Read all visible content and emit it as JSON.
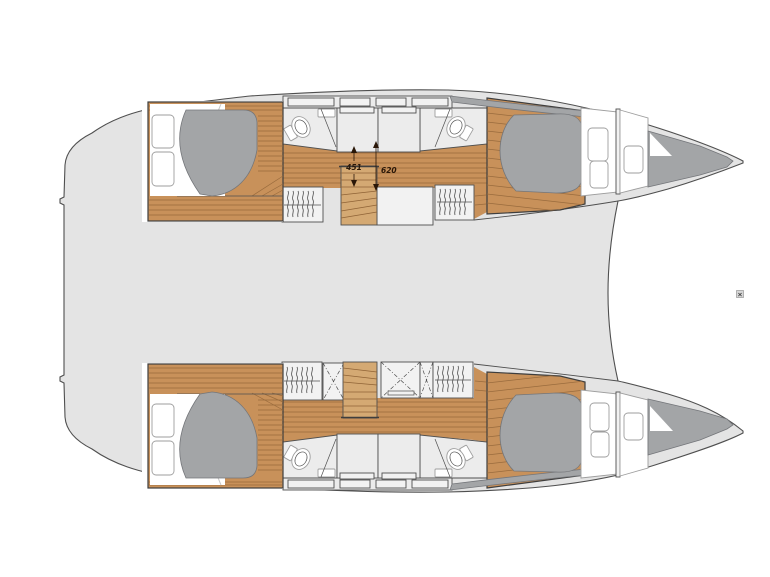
{
  "diagram": {
    "kind": "catamaran-interior-floorplan",
    "dimensions": {
      "d451": "451",
      "d620": "620"
    },
    "artifact_mark": "×",
    "colors": {
      "background": "#ffffff",
      "deck": "#e4e4e4",
      "outline": "#4f4f4f",
      "wood": "#c8915a",
      "wood_line": "#996b3d",
      "stairs_wood": "#d4a973",
      "stairs_line": "#8f6336",
      "mattress": "#a3a5a7",
      "mattress_edge": "#74767a",
      "room": "#ececec",
      "room_box": "#f2f2f2",
      "cabin_border": "#3e3e3e",
      "thin_line": "#9e9e9e",
      "fold_line": "#c9c9c9",
      "dim_text": "#2a1708"
    }
  }
}
